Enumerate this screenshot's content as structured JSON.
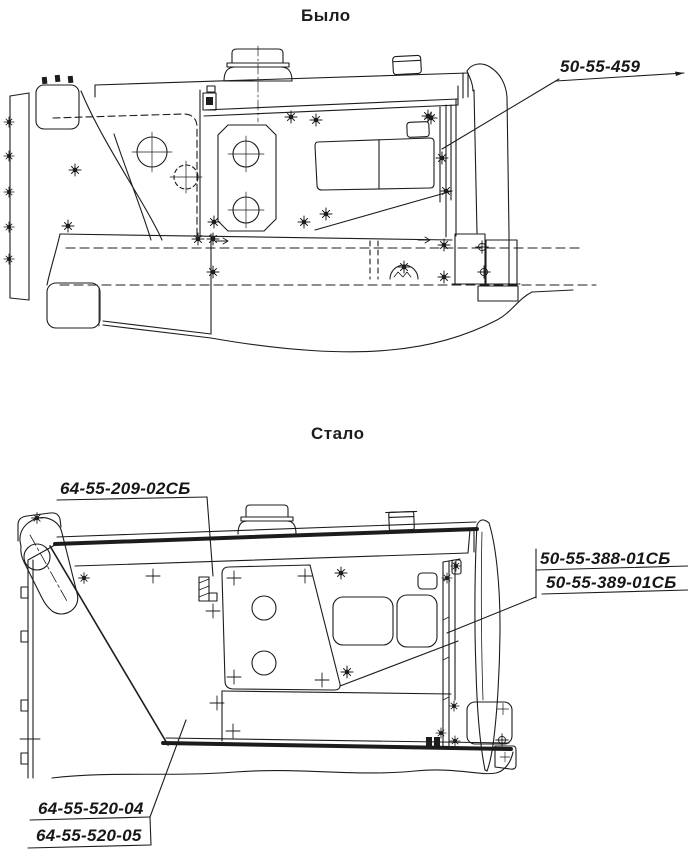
{
  "figure": {
    "background": "#ffffff",
    "ink_color": "#1c1c1c",
    "sections": {
      "before": {
        "title": "Было",
        "callouts": [
          {
            "label": "50-55-459"
          }
        ]
      },
      "after": {
        "title": "Стало",
        "callouts": [
          {
            "label": "64-55-209-02СБ"
          },
          {
            "label": "50-55-388-01СБ"
          },
          {
            "label": "50-55-389-01СБ"
          },
          {
            "label": "64-55-520-04"
          },
          {
            "label": "64-55-520-05"
          }
        ]
      }
    }
  }
}
